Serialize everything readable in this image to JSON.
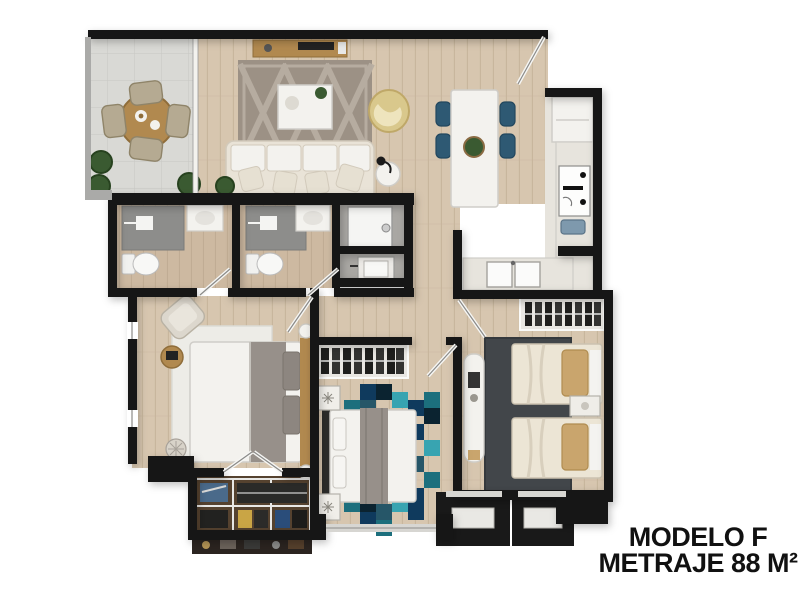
{
  "title": {
    "line1": "MODELO F",
    "line2": "METRAJE 88 M²"
  },
  "colors": {
    "wall": "#191919",
    "text": "#111111",
    "wood": "#d7c6af",
    "woodLine": "#c7b69c",
    "woodBath": "#cdb9a1",
    "woodBathLine": "#bfab92",
    "tile": "#d9d9d5",
    "tileLine": "#c7c7c3",
    "kitchenFloor": "#e7e4dd",
    "grayFloor": "#a9a7a3",
    "shower": "#8d8d8b",
    "white": "#f3f2ee",
    "whiteLine": "#cfcdc8",
    "cream": "#e9e3d7",
    "creamLine": "#d2cabb",
    "pillow": "#e6e0d2",
    "woodFurn": "#b1894f",
    "woodFurnDark": "#8f6d3a",
    "chairBeige": "#b5aa92",
    "chairBeigeLine": "#8f8469",
    "blueChair": "#2e5973",
    "blueChairDark": "#23475e",
    "yellow": "#d9c88c",
    "yellowDark": "#bfa868",
    "plant": "#3a5a31",
    "plantDark": "#27421f",
    "rugGray": "#9c9185",
    "rugGrayLine": "#b8aea2",
    "rugLight": "#edece7",
    "rugDark": "#42464a",
    "duvet": "#97908a",
    "pillowGray": "#8d8680",
    "tan": "#c9a56d",
    "bedCream": "#ece5d5",
    "closetDark": "#1f1f1f",
    "closetBg": "#e9e7e2",
    "closetFloor": "#55422f",
    "rail": "#aaaaa8",
    "sill": "#d7d6d2",
    "tealA": "#1c6f7d",
    "tealB": "#0f3a5d",
    "tealC": "#38a4b1",
    "tealD": "#0b2330",
    "tealE": "#265668",
    "appliance": "#7e99ad",
    "doorLeaf": "#f6f6f4",
    "doorLine": "#8a8a88"
  }
}
